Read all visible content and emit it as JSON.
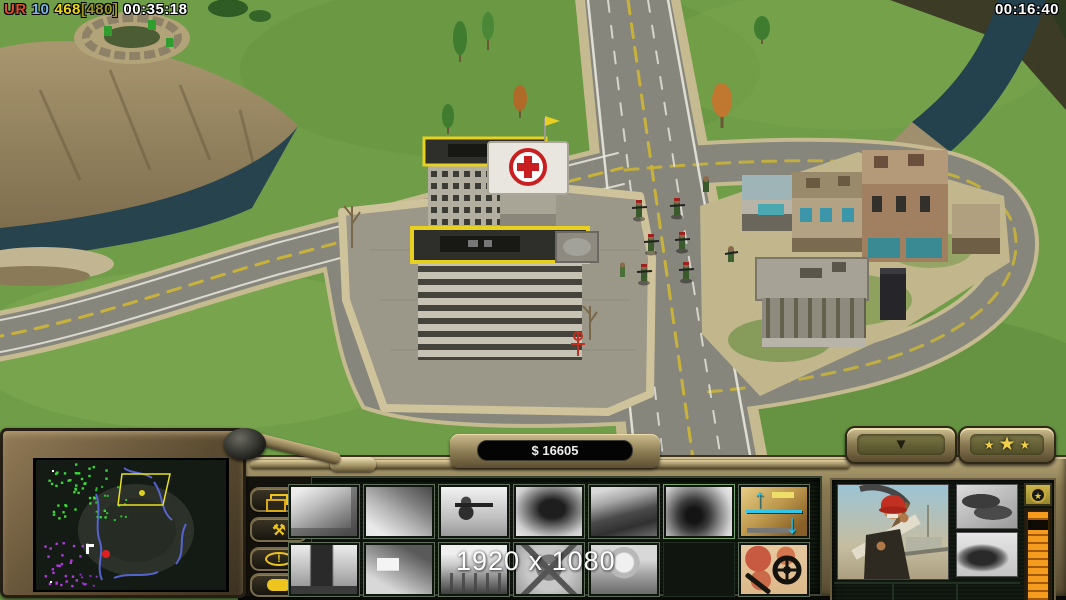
{
  "hud": {
    "top_left": {
      "tag": "UR",
      "tag_color": "#d8502e",
      "count": "10",
      "count_color": "#7ab4e8",
      "supply": "468",
      "supply_color": "#ecd81c",
      "supply_cap": "[480]",
      "supply_cap_color": "#9a9428",
      "time": "00:35:18",
      "time_color": "#ffffff"
    },
    "top_right_time": "00:16:40",
    "resolution_overlay": "1920 x 1080"
  },
  "command_bar": {
    "money": "$ 16605",
    "general_arrow": "▼",
    "stars": [
      "★",
      "★",
      "★"
    ],
    "side_buttons": {
      "b1": "stacked-windows-icon",
      "b2_glyph": "⚒",
      "b3_glyph": "!",
      "b4": "speech-bubble-icon"
    },
    "build_grid": {
      "rows": 2,
      "cols": 7,
      "row1": [
        "supply-building",
        "construction-yard",
        "rpg-soldier",
        "bunker-cave",
        "factory",
        "explosion-smoke",
        "raise-lower-building"
      ],
      "row2": [
        "supply-truck",
        "walled-compound",
        "station",
        "wheel-structure",
        "dome-building",
        "empty-slot",
        "map-scan"
      ],
      "up_arrow": "↑",
      "down_arrow": "↓"
    },
    "unit_panel": {
      "portrait": "worker-with-pickaxe-red-helmet",
      "item1": "shoes",
      "item2": "engraving",
      "emblem_star": "★"
    }
  },
  "minimap": {
    "frustum_points": "86,14 134,14 127,45 82,45",
    "frustum_color": "#e8e020",
    "river_color": "#5a6ae0",
    "clusters": [
      {
        "color": "#38d838",
        "cx": 42,
        "cy": 28,
        "spread": 30,
        "count": 46,
        "size": 2.4,
        "seed": 7
      },
      {
        "color": "#2fc02f",
        "cx": 74,
        "cy": 42,
        "spread": 18,
        "count": 16,
        "size": 2,
        "seed": 13
      },
      {
        "color": "#b238e0",
        "cx": 30,
        "cy": 104,
        "spread": 22,
        "count": 28,
        "size": 2.4,
        "seed": 29
      },
      {
        "color": "#8a2ec0",
        "cx": 54,
        "cy": 121,
        "spread": 12,
        "count": 10,
        "size": 2,
        "seed": 41
      }
    ]
  },
  "scene": {
    "colors": {
      "grass": "#6f9d48",
      "road": "#87867c",
      "water": "#27434e",
      "plaza": "#9b988a",
      "sand": "#c6ba90"
    }
  }
}
